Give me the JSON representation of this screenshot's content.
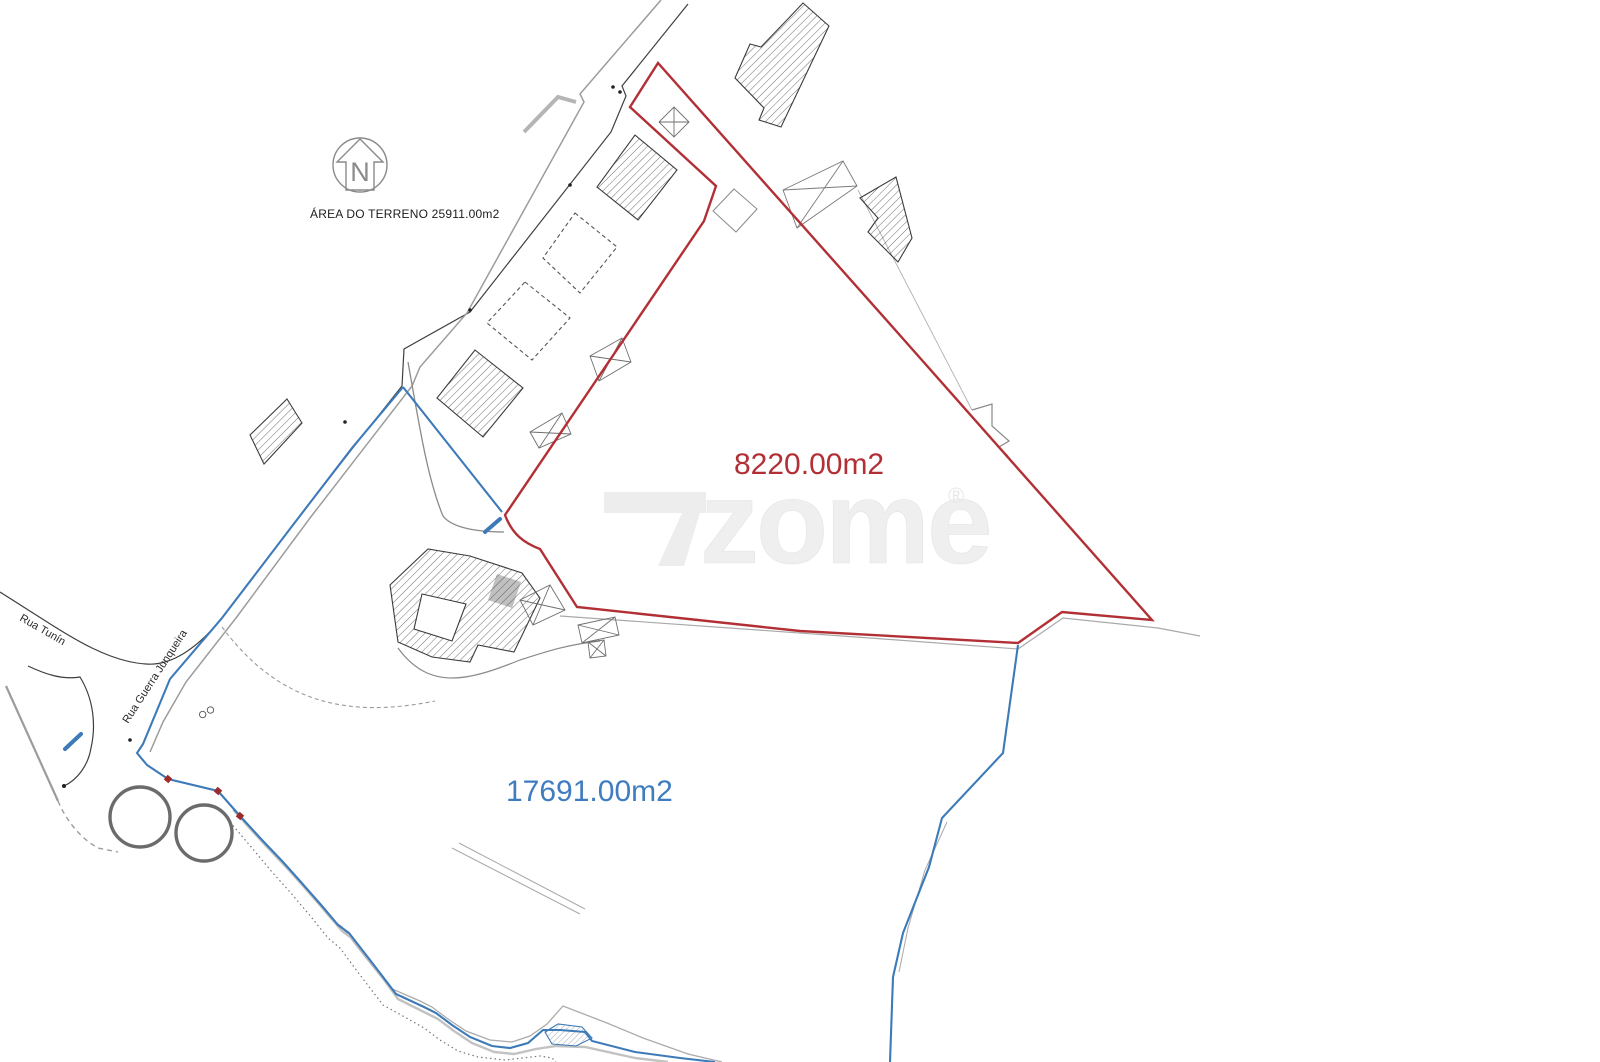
{
  "plan": {
    "total_area_label": "ÁREA DO TERRENO 25911.00m2",
    "north_letter": "N",
    "parcels": [
      {
        "id": "red-parcel",
        "area_label": "8220.00m2",
        "color": "#b23035"
      },
      {
        "id": "blue-parcel",
        "area_label": "17691.00m2",
        "color": "#3f7cc0"
      }
    ],
    "streets": [
      {
        "name": "Rua Tunín"
      },
      {
        "name": "Rua Guerra Junqueira"
      }
    ],
    "watermark": {
      "text": "zome",
      "registered_mark": "®"
    }
  },
  "colors": {
    "boundary_red": "#b23035",
    "boundary_blue": "#3d7ab8",
    "road_gray": "#9c9c9c",
    "line_black": "#3f3f3f",
    "hatch_gray": "#4a4a4a",
    "watermark_gray": "#ededed"
  }
}
